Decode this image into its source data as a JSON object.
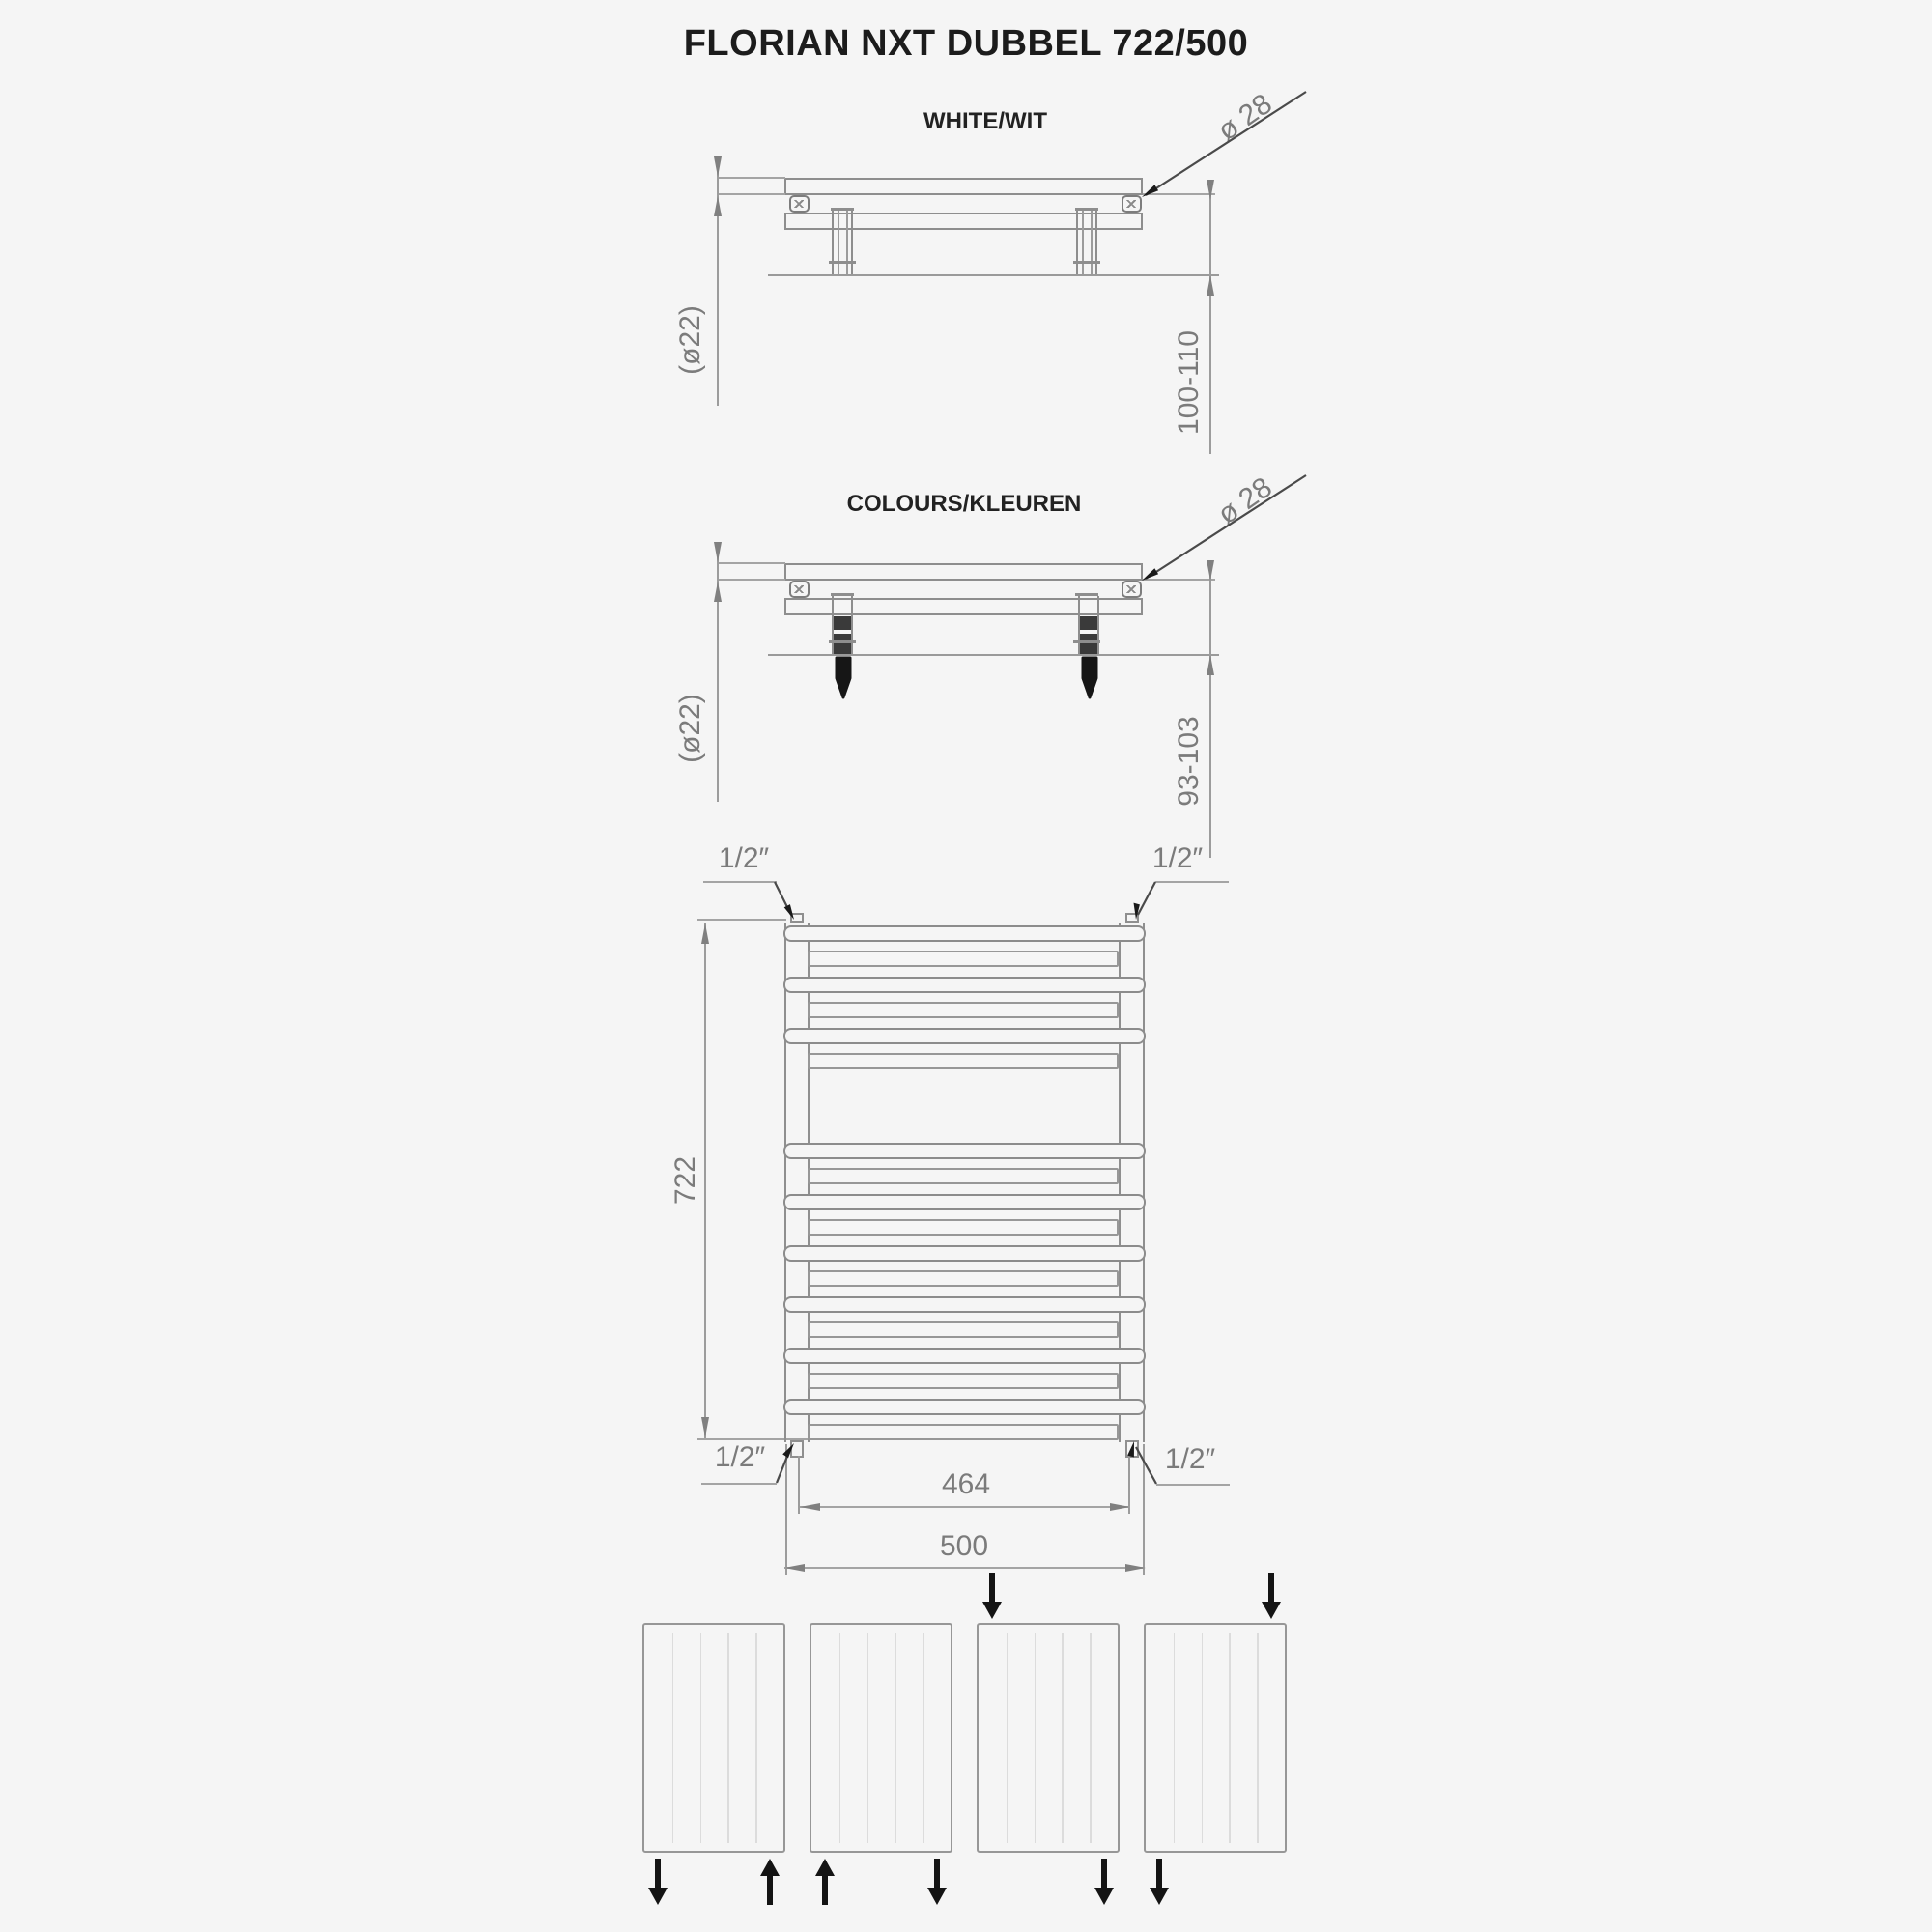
{
  "title": "FLORIAN NXT DUBBEL 722/500",
  "sections": {
    "white": {
      "label": "WHITE/WIT",
      "tube_diameter_label": "(ø22)",
      "collector_diameter_label": "ø 28",
      "wall_distance_label": "100-110"
    },
    "colours": {
      "label": "COLOURS/KLEUREN",
      "tube_diameter_label": "(ø22)",
      "collector_diameter_label": "ø 28",
      "wall_distance_label": "93-103"
    },
    "front": {
      "height_label": "722",
      "width_label": "500",
      "connection_spacing_label": "464",
      "connection_size_label": "1/2″"
    }
  },
  "front_view": {
    "top_tube_pairs": 3,
    "bottom_tube_pairs": 6
  },
  "connection_schemes": {
    "boxes": [
      {
        "arrows": [
          {
            "corner": "bottom-left",
            "dir": "down"
          },
          {
            "corner": "bottom-right",
            "dir": "up"
          }
        ]
      },
      {
        "arrows": [
          {
            "corner": "bottom-left",
            "dir": "up"
          },
          {
            "corner": "bottom-right",
            "dir": "down"
          }
        ]
      },
      {
        "arrows": [
          {
            "corner": "top-left",
            "dir": "down"
          },
          {
            "corner": "bottom-right",
            "dir": "down"
          }
        ]
      },
      {
        "arrows": [
          {
            "corner": "top-right",
            "dir": "down"
          },
          {
            "corner": "bottom-left",
            "dir": "down"
          }
        ]
      }
    ]
  }
}
